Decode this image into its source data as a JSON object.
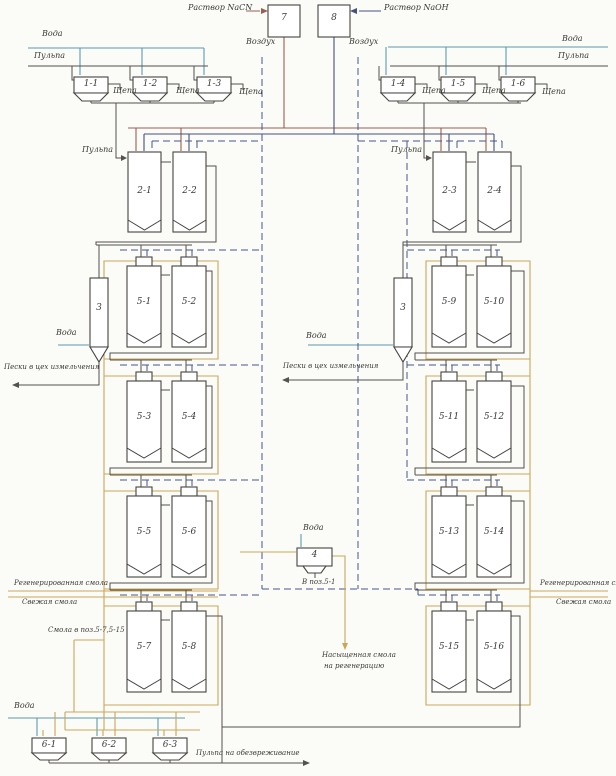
{
  "colors": {
    "background": "#fbfbf8",
    "outline": "#45443f",
    "process_line": "#53524c",
    "water_line": "#5d9ab0",
    "nacn_line": "#9a5f4f",
    "naoh_line": "#45517e",
    "air_line": "#47548c",
    "resin_line": "#c8a75a",
    "label_text": "#3a3a36"
  },
  "labels": {
    "water": "Вода",
    "pulp": "Пульпа",
    "wood_chips": "Щепа",
    "air": "Воздух",
    "nacn_solution": "Раствор NaCN",
    "naoh_solution": "Раствор NaOH",
    "sands_to_grinding": "Пески в цех измельчения",
    "regenerated_resin": "Регенерированная смола",
    "fresh_resin": "Свежая смола",
    "resin_to_pos_5_7_5_15": "Смола в поз.5-7,5-15",
    "to_pos_5_1": "В поз.5-1",
    "saturated_resin_line1": "Насыщенная смола",
    "saturated_resin_line2": "на регенерацию",
    "pulp_to_detox": "Пульпа на обезвреживание"
  },
  "units": {
    "reagent_tanks": [
      "7",
      "8"
    ],
    "washing_screens": [
      "1-1",
      "1-2",
      "1-3",
      "1-4",
      "1-5",
      "1-6"
    ],
    "agitation_tanks": [
      "2-1",
      "2-2",
      "2-3",
      "2-4"
    ],
    "sorption_columns": [
      "5-1",
      "5-2",
      "5-3",
      "5-4",
      "5-5",
      "5-6",
      "5-7",
      "5-8",
      "5-9",
      "5-10",
      "5-11",
      "5-12",
      "5-13",
      "5-14",
      "5-15",
      "5-16"
    ],
    "classifiers": [
      "3",
      "3"
    ],
    "resin_screen": "4",
    "control_screens": [
      "6-1",
      "6-2",
      "6-3"
    ]
  }
}
